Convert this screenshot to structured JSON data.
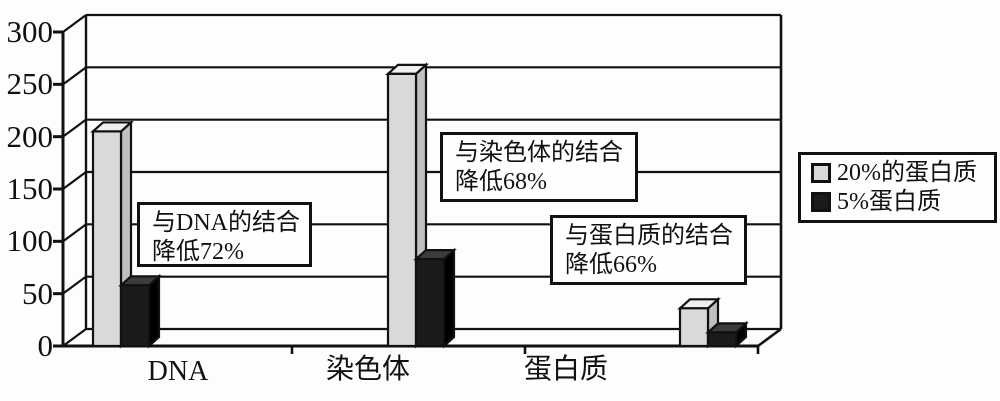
{
  "figure": {
    "background": "#fdfdfb",
    "line_color": "#111111"
  },
  "chart_data": {
    "type": "bar",
    "style": "3d-column",
    "title": "",
    "xlabel": "",
    "ylabel": "",
    "categories": [
      "DNA",
      "染色体",
      "蛋白质"
    ],
    "series": [
      {
        "name": "20%的蛋白质",
        "color": "#d9d9d9",
        "values": [
          205,
          260,
          36
        ]
      },
      {
        "name": "5%蛋白质",
        "color": "#1b1b1b",
        "values": [
          58,
          83,
          13
        ]
      }
    ],
    "ylim": [
      0,
      300
    ],
    "y_ticks": [
      300,
      250,
      200,
      150,
      100,
      50,
      0
    ],
    "grid": true,
    "legend_position": "middle-right",
    "annotations": [
      {
        "line1": "与DNA的结合",
        "line2": "降低72%"
      },
      {
        "line1": "与染色体的结合",
        "line2": "降低68%"
      },
      {
        "line1": "与蛋白质的结合",
        "line2": "降低66%"
      }
    ]
  }
}
